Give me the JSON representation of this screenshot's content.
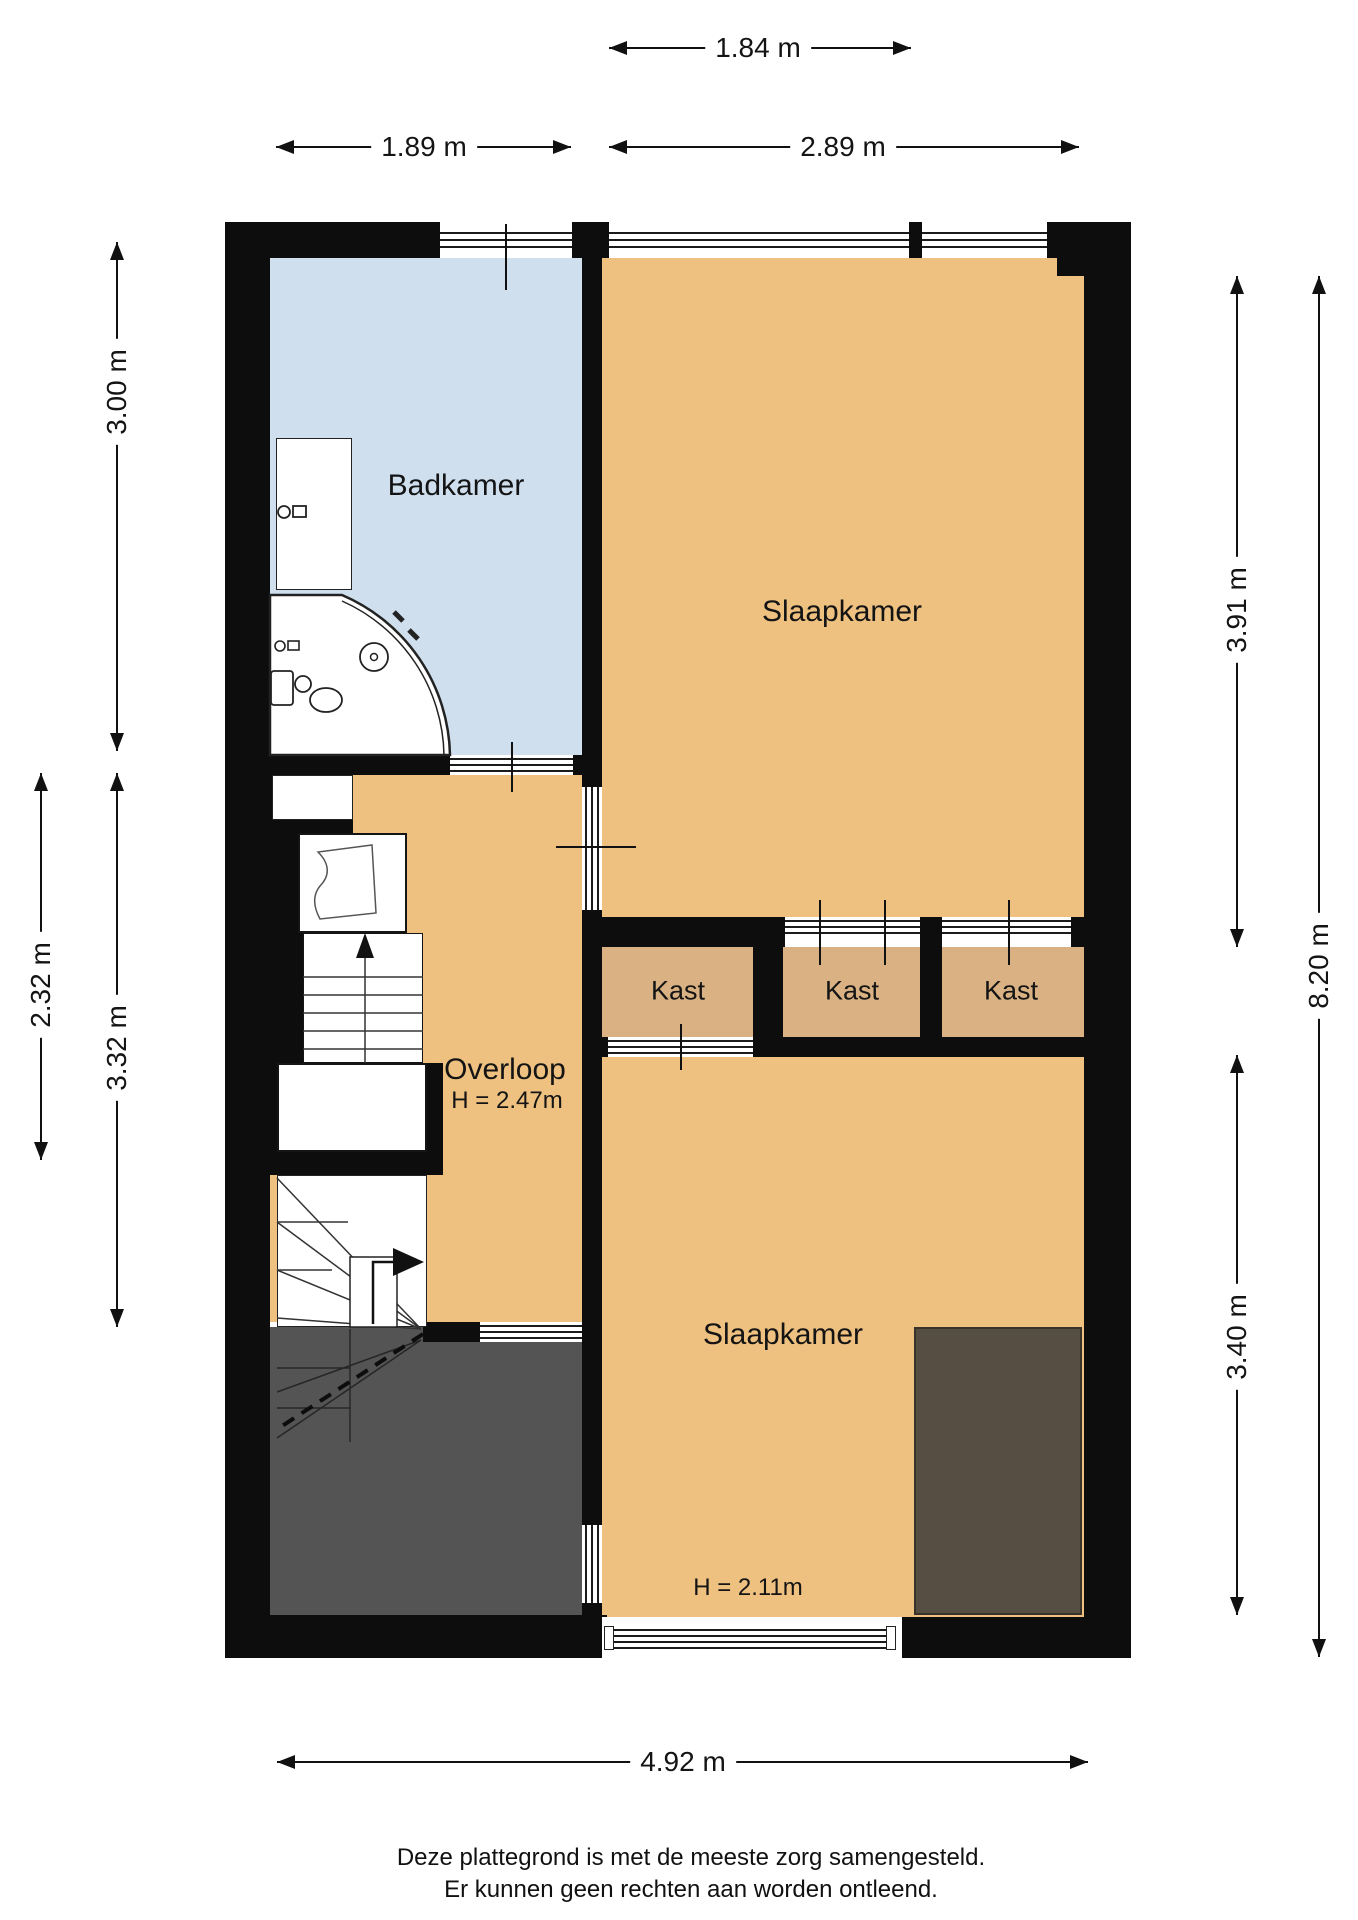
{
  "plan": {
    "rooms": {
      "badkamer": {
        "label": "Badkamer"
      },
      "slaapkamer_boven": {
        "label": "Slaapkamer"
      },
      "overloop": {
        "label": "Overloop",
        "height_label": "H = 2.47m"
      },
      "kast_links": {
        "label": "Kast"
      },
      "kast_midden": {
        "label": "Kast"
      },
      "kast_rechts": {
        "label": "Kast"
      },
      "slaapkamer_onder": {
        "label": "Slaapkamer",
        "height_label": "H = 2.11m"
      }
    },
    "dimensions": {
      "top_window": {
        "value": "1.84 m",
        "orientation": "horizontal"
      },
      "top_left": {
        "value": "1.89 m",
        "orientation": "horizontal"
      },
      "top_right": {
        "value": "2.89 m",
        "orientation": "horizontal"
      },
      "left_upper": {
        "value": "3.00 m",
        "orientation": "vertical"
      },
      "left_outer": {
        "value": "2.32 m",
        "orientation": "vertical"
      },
      "left_lower": {
        "value": "3.32 m",
        "orientation": "vertical"
      },
      "right_upper": {
        "value": "3.91 m",
        "orientation": "vertical"
      },
      "right_outer": {
        "value": "8.20 m",
        "orientation": "vertical"
      },
      "right_lower": {
        "value": "3.40 m",
        "orientation": "vertical"
      },
      "bottom": {
        "value": "4.92 m",
        "orientation": "horizontal"
      }
    },
    "colors": {
      "wall": "#0d0d0d",
      "bathroom_floor": "#cfdfee",
      "room_floor": "#eec180",
      "closet_floor": "#d9b183",
      "void_area": "#545454",
      "lowered_ceiling_block": "#564e42"
    }
  },
  "footer": {
    "line1": "Deze plattegrond is met de meeste zorg samengesteld.",
    "line2": "Er kunnen geen rechten aan worden ontleend."
  }
}
